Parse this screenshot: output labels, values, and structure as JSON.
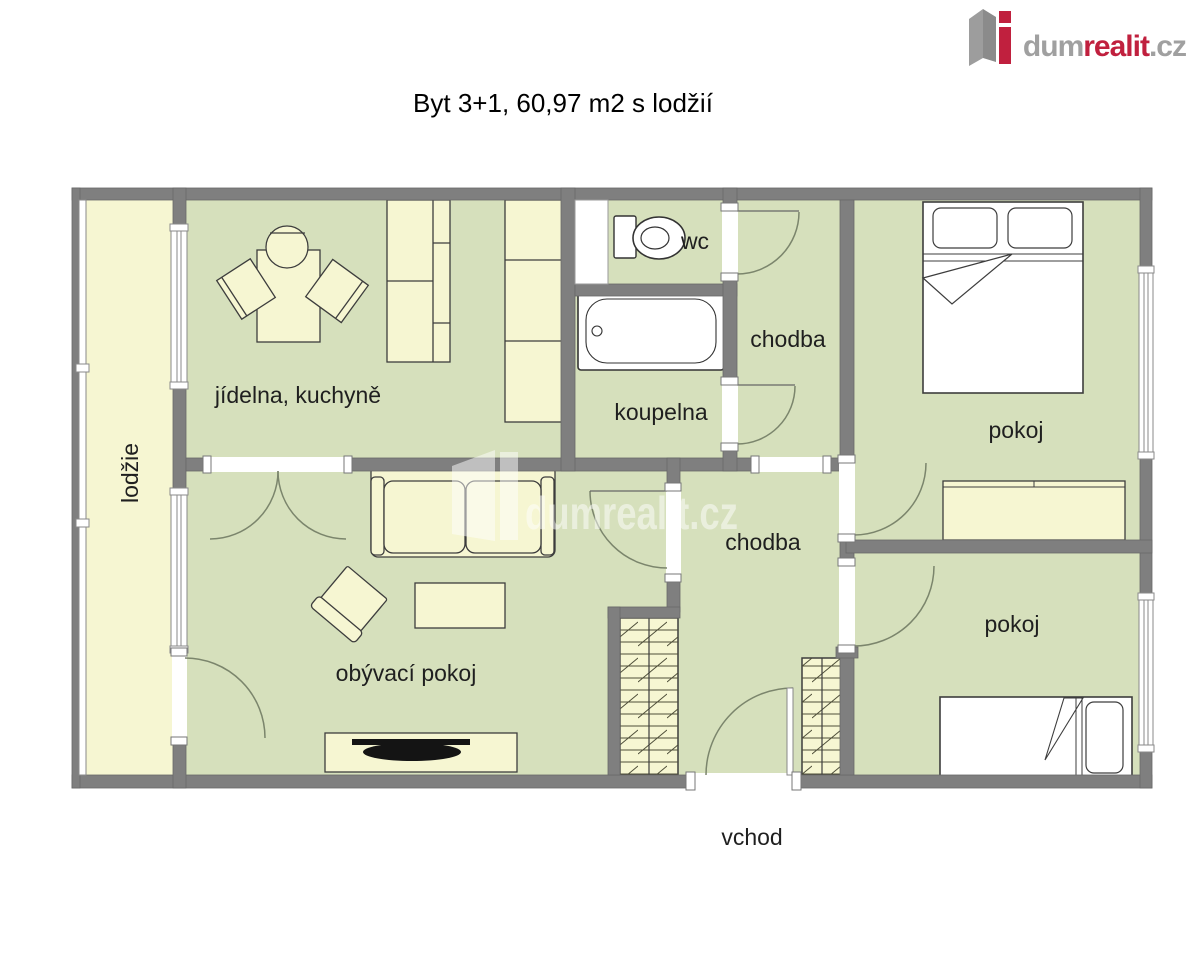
{
  "title": "Byt 3+1, 60,97 m2 s lodžií",
  "logo": {
    "part1": "dum",
    "part2": "realit",
    "part3": ".cz"
  },
  "watermark": "dumrealit.cz",
  "rooms": {
    "loggia": "lodžie",
    "kitchen": "jídelna, kuchyně",
    "wc": "wc",
    "bathroom": "koupelna",
    "hall_upper": "chodba",
    "hall_main": "chodba",
    "bedroom_top": "pokoj",
    "bedroom_bottom": "pokoj",
    "living_room": "obývací pokoj",
    "entrance": "vchod"
  },
  "colors": {
    "floor_green": "#d6e0bc",
    "furniture_cream": "#f6f6d2",
    "wall_gray": "#7f7f7f",
    "logo_red": "#c0203e",
    "logo_gray": "#a0a0a0"
  }
}
